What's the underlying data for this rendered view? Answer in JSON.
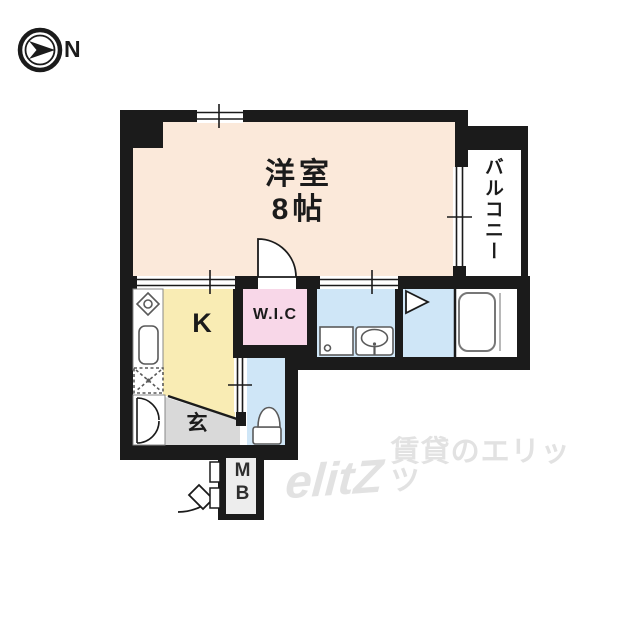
{
  "compass": {
    "label": "N"
  },
  "plan": {
    "main_room": {
      "line1": "洋室",
      "line2": "8帖"
    },
    "balcony": {
      "label": "バルコニー"
    },
    "kitchen": {
      "label": "K"
    },
    "wic": {
      "label": "W.I.C"
    },
    "genkan": {
      "label": "玄"
    },
    "meter_box": {
      "label": "MB"
    }
  },
  "watermark": {
    "logo": "elitZ",
    "text": "賃貸のエリッツ"
  },
  "colors": {
    "wall": "#1b1b1b",
    "main_room": "#fbe9da",
    "kitchen": "#f9ecb4",
    "wic": "#f8d7e8",
    "wet_area": "#cfe6f7",
    "genkan": "#d9d9d9",
    "fixture_stroke": "#5a5a5a",
    "watermark": "#e2e2e2"
  }
}
